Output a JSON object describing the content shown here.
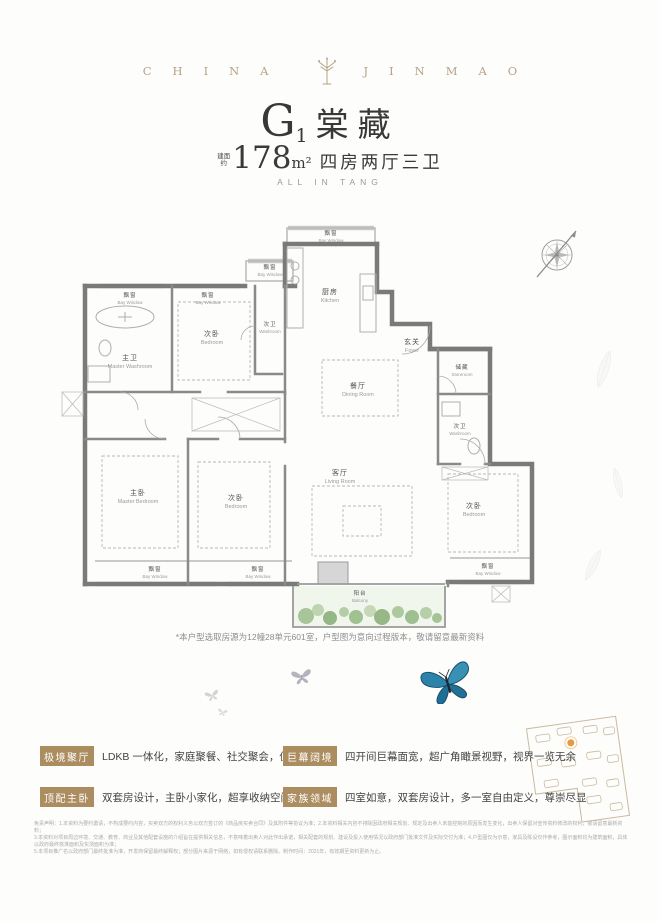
{
  "brand": {
    "left": "CHINA",
    "right": "JINMAO",
    "logo": "jinmao-tree-emblem"
  },
  "title": {
    "model": "G",
    "model_sub": "1",
    "name": "棠藏",
    "area_prefix_top": "建面",
    "area_prefix_bottom": "约",
    "area_value": "178",
    "area_unit": "m²",
    "rooms_desc": "四房两厅三卫",
    "tagline": "ALL IN TANG"
  },
  "floorplan": {
    "note": "*本户型选取房源为12幢28单元601室，户型图为意向过程版本，敬请留意最新资料",
    "rooms": {
      "bay_top": {
        "cn": "飘窗",
        "en": "Bay Window"
      },
      "bay_small": {
        "cn": "飘窗",
        "en": "Bay Window"
      },
      "bay_left1": {
        "cn": "飘窗",
        "en": "Bay Window"
      },
      "bay_left2": {
        "cn": "飘窗",
        "en": "Bay Window"
      },
      "bay_bottom1": {
        "cn": "飘窗",
        "en": "Bay Window"
      },
      "bay_bottom2": {
        "cn": "飘窗",
        "en": "Bay Window"
      },
      "bay_bottom3": {
        "cn": "飘窗",
        "en": "Bay Window"
      },
      "kitchen": {
        "cn": "厨房",
        "en": "Kitchen"
      },
      "foyer": {
        "cn": "玄关",
        "en": "Foyer"
      },
      "storeroom": {
        "cn": "储藏",
        "en": "Storeroom"
      },
      "dining": {
        "cn": "餐厅",
        "en": "Dining Room"
      },
      "living": {
        "cn": "客厅",
        "en": "Living Room"
      },
      "master_washroom": {
        "cn": "主卫",
        "en": "Master Washroom"
      },
      "washroom2": {
        "cn": "次卫",
        "en": "Washroom"
      },
      "washroom3": {
        "cn": "次卫",
        "en": "Washroom"
      },
      "master_bedroom": {
        "cn": "主卧",
        "en": "Master Bedroom"
      },
      "bedroom2": {
        "cn": "次卧",
        "en": "Bedroom"
      },
      "bedroom3": {
        "cn": "次卧",
        "en": "Bedroom"
      },
      "bedroom4": {
        "cn": "次卧",
        "en": "Bedroom"
      },
      "balcony": {
        "cn": "阳台",
        "en": "Balcony"
      }
    }
  },
  "features": [
    {
      "badge": "极境聚厅",
      "desc": "LDKB 一体化，家庭聚餐、社交聚会，仪式感拉满"
    },
    {
      "badge": "巨幕阔境",
      "desc": "四开间巨幕面宽，超广角瞰景视野，视界一览无余"
    },
    {
      "badge": "顶配主卧",
      "desc": "双套房设计，主卧小家化，超享收纳空间"
    },
    {
      "badge": "家族领域",
      "desc": "四室如意，双套房设计，多一室自由定义，尊崇尽显"
    }
  ],
  "disclaimer": [
    "免责声明：1.本资料为要约邀请，不构成要约内容，买卖双方的权利义务以双方签订的《商品房买卖合同》及其附件等协议为准；2.本资料相关内容不排除因政府相关规划、规定及出卖人未能控制的原因而发生变化，出卖人保留对宣传资料修改的权利，敬请留意最新资料；",
    "3.本资料对项目周边环境、交通、教育、商业及其他配套设施的介绍旨在提供相关信息，不意味着出卖人对此作出承诺，相关配套的规划、建设及投入使用情况以政府部门批准文件及实际交付为准；4.户型图仅为示意，家具及陈设仅作参考，图示面积均为建筑面积，具体以政府最终核准面积及实测面积为准；",
    "5.本项目推广名以政府部门最终批准为准，开发商保留最终解释权；部分图片来源于网络，如有侵权请联系删除。制作时间：2021年，有效期至资料更新为止。"
  ],
  "colors": {
    "brand_gold": "#b5a386",
    "badge_gold": "#ab8d60",
    "wall_gray": "#7a7a7a",
    "window_gray": "#c9c9c9",
    "balcony_green": "#9cbd8c",
    "butterfly_blue": "#2c83a9",
    "marker_orange": "#e59b3c"
  }
}
